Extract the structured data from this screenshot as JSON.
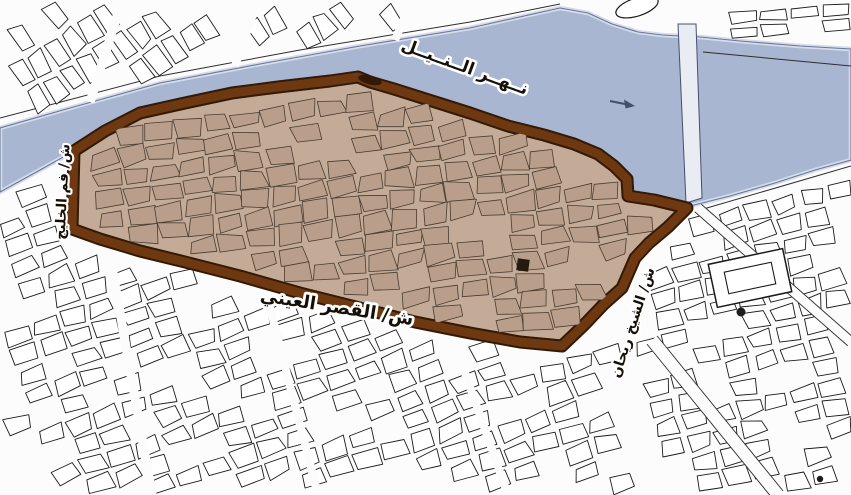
{
  "map": {
    "background": "#fcfcfc",
    "colors": {
      "river": "#a8b6d1",
      "river_edge_light": "#d6dcea",
      "river_edge_dark": "#68789b",
      "road_line": "#2e2e2e",
      "district_base": "#c4ab97",
      "district_block_fill": "#b89e8b",
      "district_block_line": "#4a3b31",
      "boundary_main": "#6e3811",
      "boundary_dark": "#321a06",
      "city_block_fill": "#ffffff",
      "city_block_line": "#1b1b1b",
      "bridge_fill": "#e9ecf3",
      "bridge_edge": "#44506b",
      "landmark_ink": "#1d1d1d",
      "label_ink": "#141008",
      "label_halo": "#ffffff"
    },
    "labels": {
      "river": {
        "text": "نــهــر الــنــيــل",
        "x": 463,
        "y": 72,
        "size": 17,
        "angle": 20
      },
      "qasr_al_aini": {
        "text": "ش/ القصر العيني",
        "x": 336,
        "y": 313,
        "size": 18,
        "angle": 9
      },
      "fam_al_khalig": {
        "text": "ش/ فم الخليج",
        "x": 67,
        "y": 192,
        "size": 14,
        "angle": -87
      },
      "sheikh_rihan": {
        "text": "ش/ الشيخ ريحان",
        "x": 637,
        "y": 324,
        "size": 14,
        "angle": -72
      }
    },
    "features": [
      {
        "name": "nile-river",
        "kind": "water-body"
      },
      {
        "name": "study-area-boundary",
        "kind": "district-outline-brown"
      },
      {
        "name": "historic-district-fabric",
        "kind": "urban-blocks-tan"
      },
      {
        "name": "surrounding-city-blocks",
        "kind": "urban-blocks-white"
      },
      {
        "name": "nile-bridge",
        "kind": "bridge"
      },
      {
        "name": "river-flow-arrow",
        "kind": "arrow"
      },
      {
        "name": "courtyard-building",
        "kind": "landmark"
      }
    ]
  }
}
